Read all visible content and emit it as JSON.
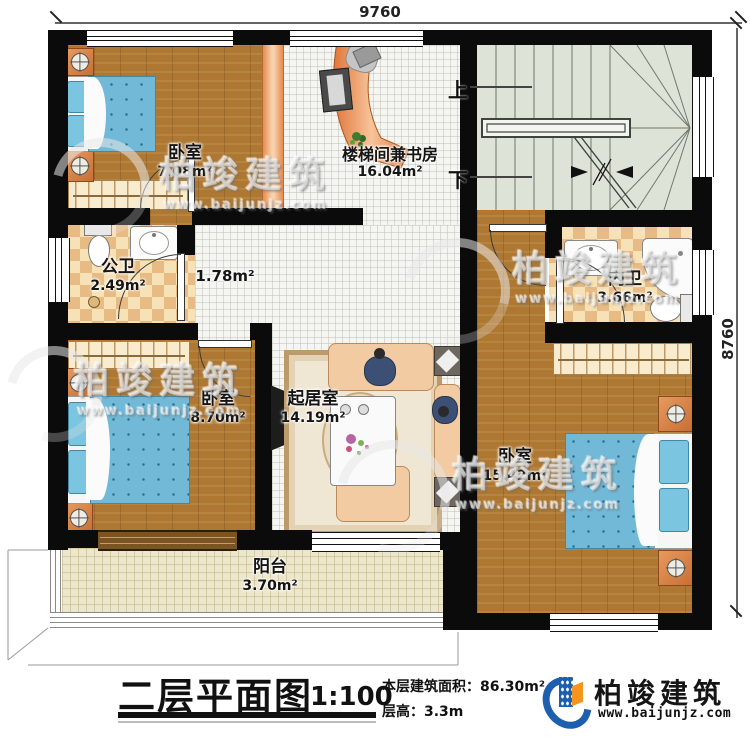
{
  "dimensions": {
    "top": "9760",
    "right": "8760"
  },
  "stairs": {
    "up": "上",
    "down": "下"
  },
  "rooms": {
    "bedroom1": {
      "name": "卧室",
      "area": "7.08m²"
    },
    "study": {
      "name": "楼梯间兼书房",
      "area": "16.04m²"
    },
    "public_bath": {
      "name": "公卫",
      "area": "2.49m²"
    },
    "hall": {
      "area": "1.78m²"
    },
    "inner_bath": {
      "name": "内卫",
      "area": "3.66m²"
    },
    "bedroom2": {
      "name": "卧室",
      "area": "8.70m²"
    },
    "living": {
      "name": "起居室",
      "area": "14.19m²"
    },
    "bedroom3": {
      "name": "卧室",
      "area": "15.42m²"
    },
    "balcony": {
      "name": "阳台",
      "area": "3.70m²"
    }
  },
  "title_block": {
    "title": "二层平面图",
    "scale": "1:100",
    "floor_area": "本层建筑面积：86.30m²",
    "floor_height": "层高：3.3m"
  },
  "brand": {
    "name": "柏竣建筑",
    "website": "www.baijunjz.com"
  },
  "watermark": {
    "name": "柏竣建筑",
    "website": "www.baijunjz.com"
  },
  "colors": {
    "wall": "#0b0b0b",
    "brand_blue": "#1c5fae",
    "brand_orange": "#f7941d",
    "bed": "#72b9d8",
    "wood": "#ae7832"
  }
}
